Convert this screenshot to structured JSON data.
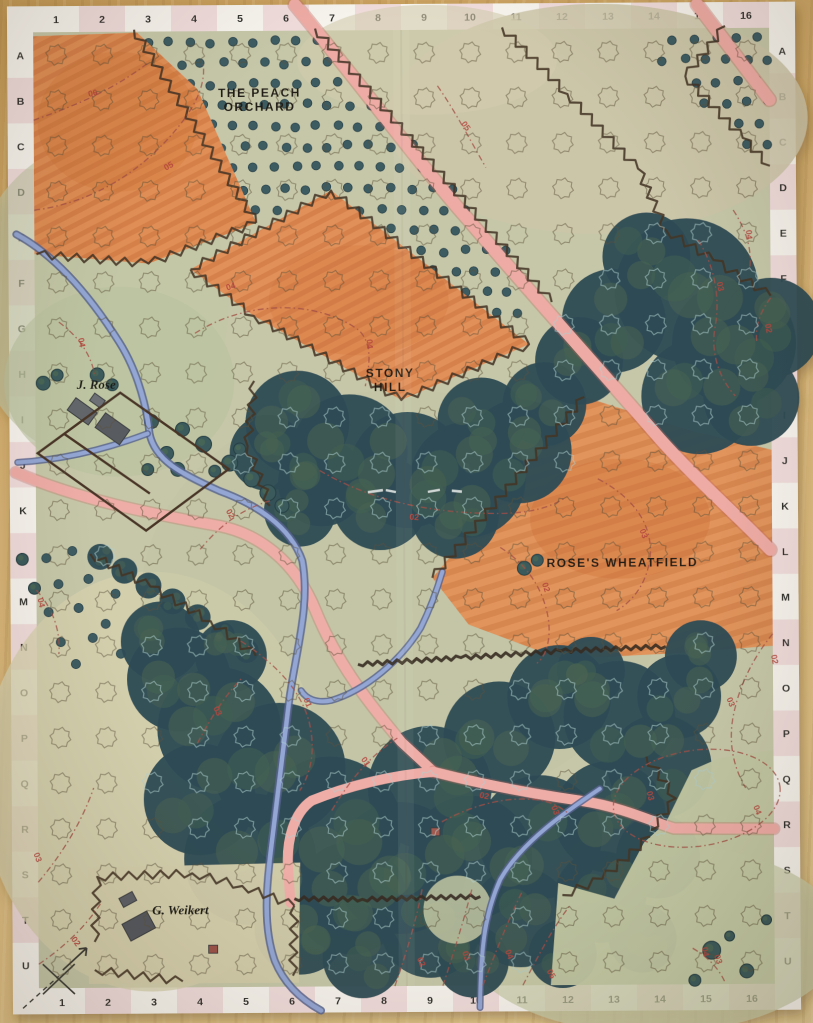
{
  "scene": {
    "description": "Hex-and-counter wargame map sheet lying on a wooden table",
    "surface": "wooden table"
  },
  "grid": {
    "columns": [
      "1",
      "2",
      "3",
      "4",
      "5",
      "6",
      "7",
      "8",
      "9",
      "10",
      "11",
      "12",
      "13",
      "14",
      "15",
      "16"
    ],
    "rows": [
      "A",
      "B",
      "C",
      "D",
      "E",
      "F",
      "G",
      "H",
      "I",
      "J",
      "K",
      "L",
      "M",
      "N",
      "O",
      "P",
      "Q",
      "R",
      "S",
      "T",
      "U"
    ]
  },
  "area_labels": [
    {
      "id": "peach-orchard",
      "lines": [
        "THE PEACH",
        "ORCHARD"
      ],
      "x": 262,
      "y": 96
    },
    {
      "id": "stony-hill",
      "lines": [
        "STONY",
        "HILL"
      ],
      "x": 391,
      "y": 377
    },
    {
      "id": "roses-wheatfield",
      "lines": [
        "ROSE'S WHEATFIELD"
      ],
      "x": 622,
      "y": 568
    }
  ],
  "farm_labels": [
    {
      "id": "j-rose",
      "text": "J. Rose",
      "x": 97,
      "y": 387
    },
    {
      "id": "g-weikert",
      "text": "G. Weikert",
      "x": 178,
      "y": 913
    }
  ],
  "contour_labels": [
    {
      "t": "06",
      "x": 96,
      "y": 94,
      "r": -12
    },
    {
      "t": "05",
      "x": 172,
      "y": 167,
      "r": -28
    },
    {
      "t": "05",
      "x": 466,
      "y": 128,
      "r": 55
    },
    {
      "t": "04",
      "x": 233,
      "y": 288,
      "r": -18
    },
    {
      "t": "04",
      "x": 368,
      "y": 344,
      "r": 85
    },
    {
      "t": "04",
      "x": 80,
      "y": 341,
      "r": 80
    },
    {
      "t": "04",
      "x": 748,
      "y": 237,
      "r": 85
    },
    {
      "t": "03",
      "x": 719,
      "y": 289,
      "r": 78
    },
    {
      "t": "02",
      "x": 767,
      "y": 331,
      "r": 80
    },
    {
      "t": "02",
      "x": 414,
      "y": 520,
      "r": 4
    },
    {
      "t": "02",
      "x": 228,
      "y": 514,
      "r": 62
    },
    {
      "t": "03",
      "x": 641,
      "y": 536,
      "r": 70
    },
    {
      "t": "02",
      "x": 543,
      "y": 589,
      "r": 72
    },
    {
      "t": "04",
      "x": 38,
      "y": 601,
      "r": 78
    },
    {
      "t": "03",
      "x": 214,
      "y": 711,
      "r": 65
    },
    {
      "t": "01",
      "x": 304,
      "y": 703,
      "r": 68
    },
    {
      "t": "01",
      "x": 362,
      "y": 763,
      "r": 55
    },
    {
      "t": "02",
      "x": 482,
      "y": 799,
      "r": 12
    },
    {
      "t": "03",
      "x": 551,
      "y": 812,
      "r": 70
    },
    {
      "t": "02",
      "x": 771,
      "y": 662,
      "r": 80
    },
    {
      "t": "03",
      "x": 727,
      "y": 705,
      "r": 68
    },
    {
      "t": "03",
      "x": 646,
      "y": 798,
      "r": 75
    },
    {
      "t": "04",
      "x": 753,
      "y": 813,
      "r": 70
    },
    {
      "t": "03",
      "x": 33,
      "y": 856,
      "r": 70
    },
    {
      "t": "02",
      "x": 71,
      "y": 941,
      "r": 55
    },
    {
      "t": "02",
      "x": 416,
      "y": 963,
      "r": 68
    },
    {
      "t": "03",
      "x": 461,
      "y": 957,
      "r": 72
    },
    {
      "t": "04",
      "x": 504,
      "y": 956,
      "r": 68
    },
    {
      "t": "05",
      "x": 546,
      "y": 976,
      "r": 62
    },
    {
      "t": "04",
      "x": 700,
      "y": 954,
      "r": 80
    },
    {
      "t": "03",
      "x": 713,
      "y": 962,
      "r": 72
    }
  ],
  "colors": {
    "table_wood": "#d9b577",
    "sheet_white": "#f4f1e8",
    "border_pink": "#f0dcdb",
    "paper_green": "#c6c7a9",
    "field_orange": "#e08e54",
    "woods_dark": "#2f4c55",
    "orchard_dot": "#3c5c62",
    "road_pink": "#eeaba5",
    "stream_blue": "#8199cc",
    "contour_red": "#a34f46",
    "boundary_brown": "#443425"
  }
}
